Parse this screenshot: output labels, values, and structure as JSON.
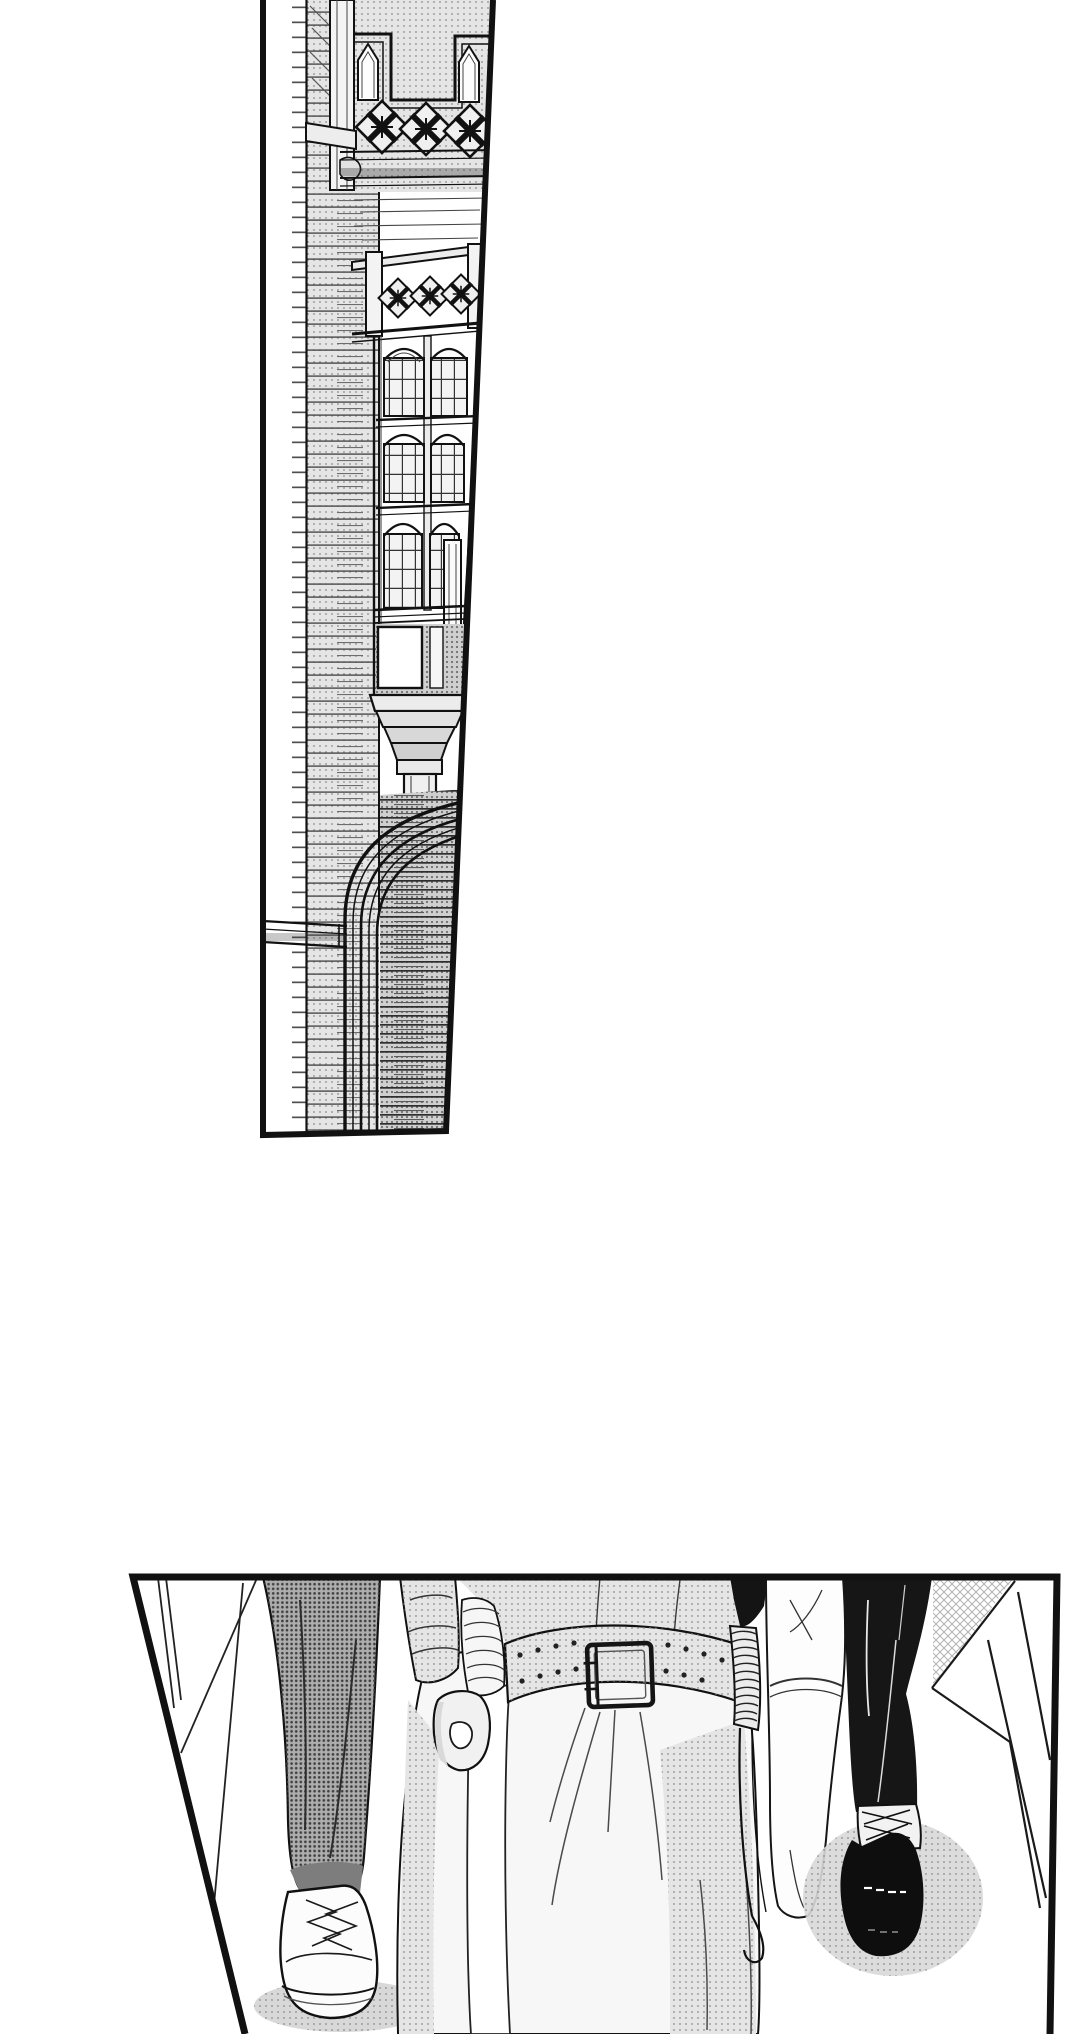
{
  "page": {
    "type": "manga page",
    "width_px": 1080,
    "height_px": 2034,
    "background": "#ffffff",
    "description": "Black-and-white manga page with two panels on a white margin: a tall slanted panel showing a Gothic brick building facade, and a wide lower panel showing the legs and feet of three people walking."
  },
  "colors": {
    "paper": "#ffffff",
    "ink": "#111111",
    "tone-light": "#e5e5e5",
    "tone-mid": "#cfcfcf",
    "tone-dark": "#adadad",
    "tone-shadow": "#d8d8d8"
  },
  "panels": [
    {
      "name": "building-exterior-panel",
      "shape": "tall slanted trapezoid, bleeds off the top edge",
      "description": "Exterior of a Victorian Gothic brick building: parapet balustrade pierced with cross-in-diamond motifs, lancet openings, a multi-storey oriel bay window with arched leaded lights, a moulded corbel on a slender column, and a deep arched gateway over stacked string courses.",
      "contents": [
        "brick wall with halftone courses",
        "parapet balustrade with diamond cross motifs",
        "crown balustrade of oriel",
        "three tiers of arched mullioned windows",
        "blank white pane",
        "corbel mouldings and column",
        "arched gateway with multiple orders",
        "striped shadow wall under arch"
      ]
    },
    {
      "name": "walking-feet-panel",
      "shape": "wide trapezoid with slanted left edge, bleeds off the bottom edge",
      "description": "Street-level close-up of three figures walking toward the viewer: grey halftone trousers with a white lace-up sneaker, a long white skirt with a wide pale studded belt and square double-prong buckle with a corded strap hanging beside a clenched fist and bandaged forearm, and black trousers over a black laced derby shoe next to a white coat hem with sharp fold lines.",
      "figures": [
        {
          "name": "sneaker-walker",
          "details": "grey halftone trousers, white sneaker with zigzag laces, halftone cast shadow"
        },
        {
          "name": "white-skirt-walker",
          "details": "white blouse and long skirt, wide belt with two rows of stud holes, square double-prong buckle, white hanging sash, bandaged forearm, clenched fist, ribbed corded strap ending in a hook"
        },
        {
          "name": "black-shoe-walker",
          "details": "black trousers with thin highlights, white sleeve with cuff, black derby shoe with crossed laces and white highlight dashes, halftone shadow, white coat hem with V-shaped fold lines and crosshatch tone"
        }
      ]
    }
  ]
}
